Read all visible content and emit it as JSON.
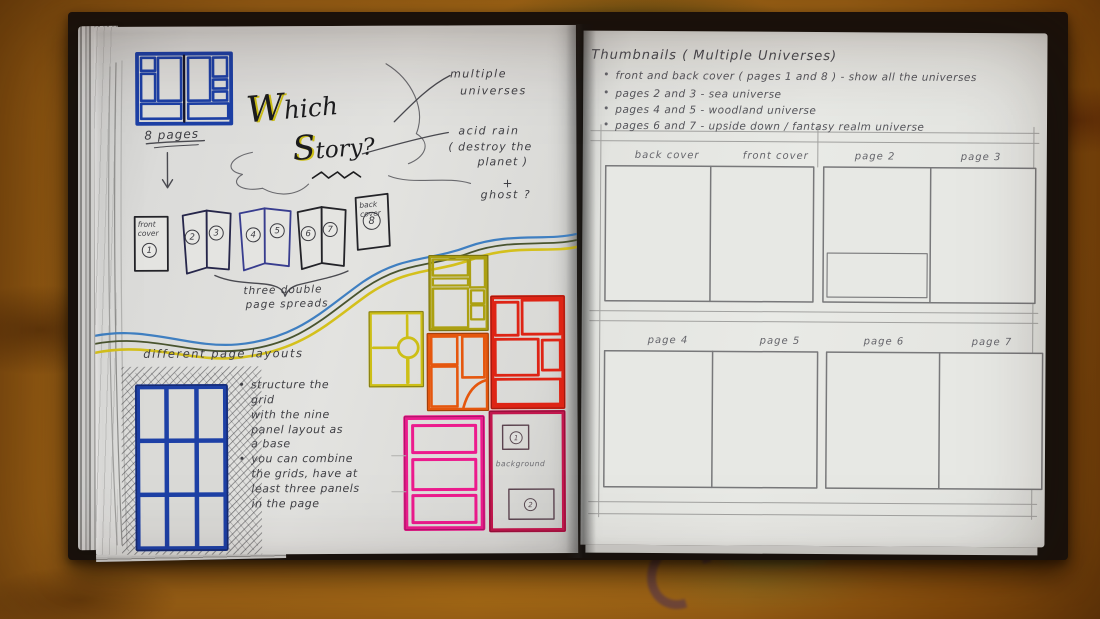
{
  "left_page": {
    "pages_label": "8 pages",
    "title": {
      "which_cap": "W",
      "which_rest": "hich",
      "story_cap": "S",
      "story_rest": "tory?"
    },
    "notes": {
      "multiple_1": "multiple",
      "multiple_2": "universes",
      "acid_1": "acid rain",
      "acid_2": "( destroy the",
      "acid_3": "planet )",
      "plus": "+",
      "ghost": "ghost ?"
    },
    "covers": {
      "front": "front cover",
      "back": "back cover"
    },
    "page_numbers": [
      "1",
      "2",
      "3",
      "4",
      "5",
      "6",
      "7",
      "8"
    ],
    "spreads_caption_1": "three double",
    "spreads_caption_2": "page spreads",
    "layouts_heading": "different page layouts",
    "bullets": [
      "structure the grid\nwith the nine\npanel layout as\na base",
      "you can combine\nthe grids, have at\nleast three panels\nin the page"
    ],
    "background_label": "background"
  },
  "right_page": {
    "heading": "Thumbnails ( Multiple Universes)",
    "bullets": [
      "front and back cover ( pages 1 and 8 ) - show all the universes",
      "pages 2 and 3  -  sea universe",
      "pages 4 and 5  -  woodland universe",
      "pages 6 and 7  -  upside down / fantasy realm universe"
    ],
    "labels": [
      "back cover",
      "front cover",
      "page 2",
      "page 3",
      "page 4",
      "page 5",
      "page 6",
      "page 7"
    ]
  },
  "glyphs": {
    "bullet": "•"
  },
  "colors": {
    "paper": "#e2e2df",
    "table": "#b4751a",
    "ink": "#2a2a2e",
    "pencil": "#8a8a8a",
    "blue": "#1d40a6",
    "yellow": "#cdbf16",
    "olive": "#aca012",
    "orange": "#e5570e",
    "red": "#de2415",
    "pink": "#ec1b8d",
    "crimson": "#c2164d",
    "wave_blue": "#3f7fc1",
    "wave_yellow": "#d4c01c",
    "wave_dark": "#49542f"
  }
}
